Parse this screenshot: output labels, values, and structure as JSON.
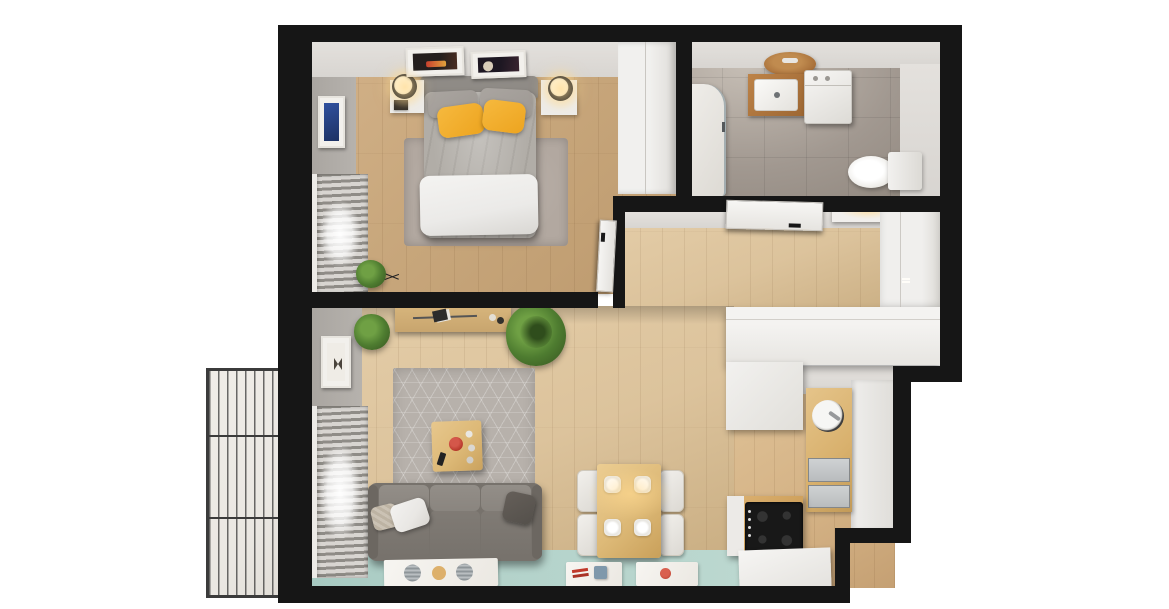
{
  "scene": {
    "title": "apartment-3d-floor-plan",
    "view": "top-down-cutaway-render",
    "canvas": {
      "width": 1169,
      "height": 609
    }
  },
  "palette": {
    "background": "#ffffff",
    "wall_black": "#161616",
    "wall_face_light": "#d8d5d1",
    "wall_face_mid": "#b6b2ad",
    "wood_bedroom": "#c8a77c",
    "wood_hall": "#dcc39c",
    "wood_kitchen": "#d4b285",
    "tile_bath": "#a19890",
    "floor_teal": "#b3d2ca",
    "balcony_concrete": "#eae7e2",
    "railing_metal": "#3b3b3b",
    "furniture_white": "#edecea",
    "door_white": "#f2f1ef",
    "sofa_back": "#8a857f",
    "sofa_seat": "#77726c",
    "cushion_white": "#e9e7e4",
    "cushion_knit": "#cbc2b4",
    "cushion_dark": "#54504b",
    "rug_living": "#b7b1ab",
    "rug_bedroom": "#b2a8a0",
    "bed_duvet": "#b1ada7",
    "bed_blanket": "#ebeae8",
    "bed_headboard": "#8f8b86",
    "pillow_gray": "#9d9893",
    "pillow_yellow": "#eda41f",
    "wood_counter": "#d8b06c",
    "wood_dining": "#ddb977",
    "wood_console": "#c8a56e",
    "wood_stove": "#cfa15c",
    "wood_mirror": "#a8703a",
    "cooktop_black": "#181818",
    "steel": "#b9bcbe",
    "plant_green": "#4e7c30",
    "plant_dark": "#35521f",
    "accent_red": "#b8392c",
    "art_blue": "#30509e",
    "glow_warm": "#ffd98f"
  },
  "rooms": [
    {
      "name": "bedroom",
      "floor": "light-oak-wood",
      "furniture": [
        "double-bed",
        "gray-duvet",
        "white-blanket",
        "gray-pillows",
        "yellow-pillows",
        "headboard",
        "nightstand-left",
        "nightstand-right",
        "table-lamp-left",
        "table-lamp-right",
        "wall-art-1",
        "wall-art-2",
        "blue-wall-art",
        "area-rug",
        "window-blinds",
        "plant-on-wire-stand",
        "built-in-wardrobe",
        "open-door"
      ]
    },
    {
      "name": "bathroom",
      "floor": "gray-tile",
      "furniture": [
        "shower-enclosure",
        "round-wood-mirror",
        "washbasin",
        "washing-machine",
        "toilet"
      ]
    },
    {
      "name": "hallway",
      "floor": "light-oak-wood",
      "furniture": [
        "open-door-panel",
        "ceiling-light-panel",
        "wardrobe"
      ]
    },
    {
      "name": "kitchen",
      "floor": "light-oak-wood",
      "furniture": [
        "cabinet-row",
        "white-cabinet-block",
        "wood-countertop",
        "round-sink",
        "steel-sink-unit",
        "cooktop-stove",
        "white-counter-right",
        "white-slab"
      ]
    },
    {
      "name": "living-room",
      "floor": "wood-with-teal-strip",
      "furniture": [
        "three-seat-sofa",
        "white-cushion",
        "knit-cushion",
        "dark-cushion",
        "geometric-rug",
        "coffee-table",
        "red-vase",
        "remote-control",
        "console-shelf",
        "tall-plant",
        "small-plant",
        "wall-art",
        "window-blinds",
        "dining-table",
        {
          "name": "dining-chair",
          "count": 4
        },
        {
          "name": "plate",
          "count": 4
        },
        {
          "name": "floor-mat",
          "count": 3
        }
      ]
    },
    {
      "name": "balcony",
      "floor": "concrete",
      "furniture": [
        "metal-bar-railing"
      ]
    }
  ]
}
